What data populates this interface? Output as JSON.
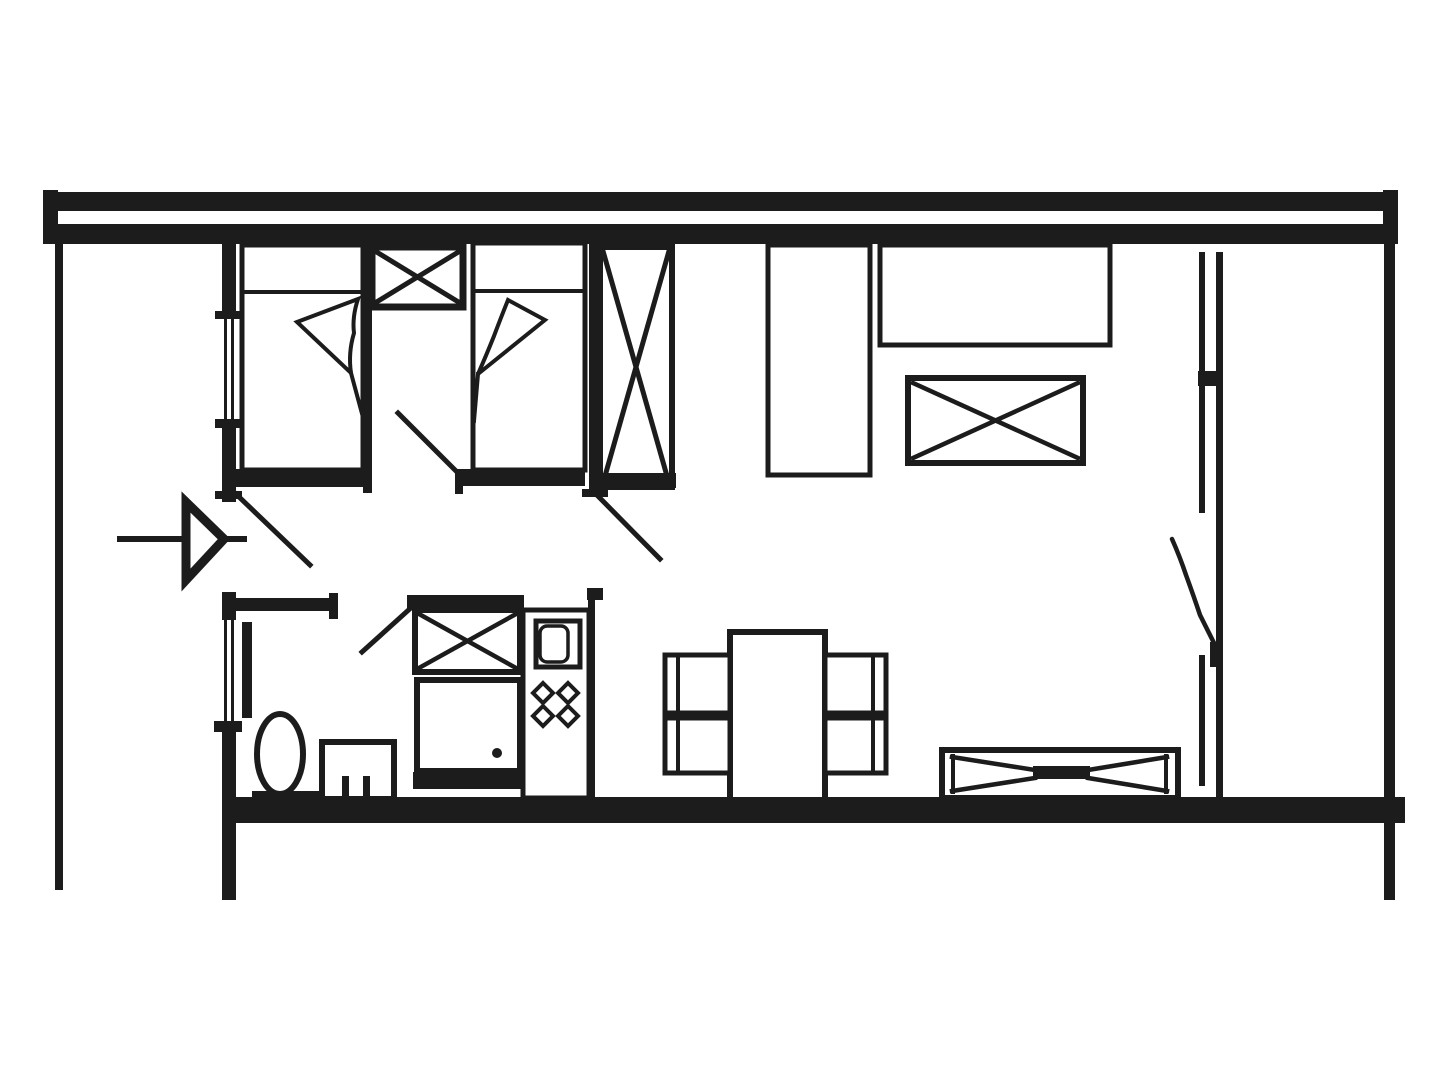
{
  "document": {
    "kind": "architectural-floor-plan",
    "canvas": {
      "width": 1440,
      "height": 1080,
      "background": "#ffffff",
      "ink": "#1c1c1c"
    }
  },
  "shapes": [
    {
      "n": "top-wall-upper-bar",
      "t": "r",
      "x": 43,
      "y": 192,
      "w": 1355,
      "h": 19,
      "f": true
    },
    {
      "n": "top-wall-lower-bar",
      "t": "r",
      "x": 55,
      "y": 224,
      "w": 1342,
      "h": 20,
      "f": true
    },
    {
      "n": "top-wall-left-cap",
      "t": "r",
      "x": 43,
      "y": 190,
      "w": 15,
      "h": 54,
      "f": true
    },
    {
      "n": "top-wall-right-cap",
      "t": "r",
      "x": 1383,
      "y": 190,
      "w": 15,
      "h": 54,
      "f": true
    },
    {
      "n": "terrace-left-edge-wall",
      "t": "r",
      "x": 55,
      "y": 244,
      "w": 8,
      "h": 646,
      "f": true
    },
    {
      "n": "outer-wall-right",
      "t": "r",
      "x": 1384,
      "y": 244,
      "w": 11,
      "h": 656,
      "f": true
    },
    {
      "n": "bottom-wall",
      "t": "r",
      "x": 222,
      "y": 797,
      "w": 1183,
      "h": 26,
      "f": true
    },
    {
      "n": "left-wall-segment-a",
      "t": "r",
      "x": 222,
      "y": 244,
      "w": 14,
      "h": 69,
      "f": true
    },
    {
      "n": "left-wall-tick-1",
      "t": "r",
      "x": 215,
      "y": 311,
      "w": 27,
      "h": 8,
      "f": true
    },
    {
      "n": "bedroom-window-glass-a",
      "t": "r",
      "x": 224,
      "y": 319,
      "w": 3,
      "h": 103,
      "f": true
    },
    {
      "n": "bedroom-window-glass-b",
      "t": "r",
      "x": 231,
      "y": 319,
      "w": 3,
      "h": 103,
      "f": true
    },
    {
      "n": "left-wall-tick-2",
      "t": "r",
      "x": 215,
      "y": 419,
      "w": 27,
      "h": 9,
      "f": true
    },
    {
      "n": "left-wall-segment-b",
      "t": "r",
      "x": 222,
      "y": 428,
      "w": 14,
      "h": 74,
      "f": true
    },
    {
      "n": "left-wall-tick-3",
      "t": "r",
      "x": 215,
      "y": 491,
      "w": 27,
      "h": 8,
      "f": true
    },
    {
      "n": "left-wall-segment-c",
      "t": "r",
      "x": 222,
      "y": 592,
      "w": 14,
      "h": 28,
      "f": true
    },
    {
      "n": "bathroom-window-glass-a",
      "t": "r",
      "x": 224,
      "y": 620,
      "w": 3,
      "h": 103,
      "f": true
    },
    {
      "n": "bathroom-window-glass-b",
      "t": "r",
      "x": 231,
      "y": 620,
      "w": 3,
      "h": 103,
      "f": true
    },
    {
      "n": "left-wall-tick-4",
      "t": "r",
      "x": 214,
      "y": 721,
      "w": 28,
      "h": 11,
      "f": true
    },
    {
      "n": "left-wall-segment-d",
      "t": "r",
      "x": 222,
      "y": 732,
      "w": 14,
      "h": 168,
      "f": true
    },
    {
      "n": "bathroom-wall",
      "t": "r",
      "x": 232,
      "y": 598,
      "w": 102,
      "h": 13,
      "f": true
    },
    {
      "n": "bathroom-wall-end-tick",
      "t": "r",
      "x": 329,
      "y": 593,
      "w": 9,
      "h": 26,
      "f": true
    },
    {
      "n": "bed-divider-wall",
      "t": "r",
      "x": 363,
      "y": 244,
      "w": 9,
      "h": 249,
      "f": true
    },
    {
      "n": "bedroom2-right-wall",
      "t": "r",
      "x": 589,
      "y": 238,
      "w": 10,
      "h": 252,
      "f": true
    },
    {
      "n": "bedroom2-wall-tick",
      "t": "r",
      "x": 582,
      "y": 489,
      "w": 26,
      "h": 8,
      "f": true
    },
    {
      "n": "bed-1",
      "t": "r",
      "x": 242,
      "y": 245,
      "w": 121,
      "h": 225,
      "sw": 5
    },
    {
      "n": "bed-1-pillow-line",
      "t": "l",
      "x1": 242,
      "y1": 292,
      "x2": 363,
      "y2": 292,
      "sw": 4
    },
    {
      "n": "bed-1-blanket-fold",
      "t": "p",
      "d": "M297,322 L358,299 Q352,317 354,333 Q348,353 351,373 Z",
      "sw": 4,
      "fill": "#ffffff"
    },
    {
      "n": "bed-1-blanket-tail",
      "t": "l",
      "x1": 351,
      "y1": 373,
      "x2": 364,
      "y2": 421,
      "sw": 4
    },
    {
      "n": "bed-1-foot-bar",
      "t": "r",
      "x": 228,
      "y": 469,
      "w": 137,
      "h": 18,
      "f": true
    },
    {
      "n": "wardrobe-small-crossed-box",
      "t": "r",
      "x": 372,
      "y": 247,
      "w": 91,
      "h": 60,
      "sw": 7
    },
    {
      "n": "wardrobe-small-x-line-a",
      "t": "l",
      "x1": 375,
      "y1": 251,
      "x2": 460,
      "y2": 303,
      "sw": 5
    },
    {
      "n": "wardrobe-small-x-line-b",
      "t": "l",
      "x1": 460,
      "y1": 251,
      "x2": 375,
      "y2": 303,
      "sw": 5
    },
    {
      "n": "bed-2",
      "t": "r",
      "x": 473,
      "y": 243,
      "w": 112,
      "h": 227,
      "sw": 5
    },
    {
      "n": "bed-2-pillow-line",
      "t": "l",
      "x1": 473,
      "y1": 291,
      "x2": 585,
      "y2": 291,
      "sw": 4
    },
    {
      "n": "bed-2-blanket-fold",
      "t": "p",
      "d": "M545,320 L508,300 Q500,320 494,336 Q486,356 478,374 Z",
      "sw": 4,
      "fill": "#ffffff"
    },
    {
      "n": "bed-2-blanket-tail",
      "t": "l",
      "x1": 478,
      "y1": 374,
      "x2": 474,
      "y2": 421,
      "sw": 4
    },
    {
      "n": "bed-2-foot-bar",
      "t": "r",
      "x": 456,
      "y": 469,
      "w": 129,
      "h": 17,
      "f": true
    },
    {
      "n": "bed-2-foot-tick",
      "t": "r",
      "x": 455,
      "y": 469,
      "w": 8,
      "h": 25,
      "f": true
    },
    {
      "n": "wardrobe-tall-crossed-box",
      "t": "r",
      "x": 600,
      "y": 247,
      "w": 72,
      "h": 240,
      "sw": 6
    },
    {
      "n": "wardrobe-tall-x-line-a",
      "t": "l",
      "x1": 603,
      "y1": 251,
      "x2": 669,
      "y2": 483,
      "sw": 5
    },
    {
      "n": "wardrobe-tall-x-line-b",
      "t": "l",
      "x1": 669,
      "y1": 251,
      "x2": 603,
      "y2": 483,
      "sw": 5
    },
    {
      "n": "wardrobe-tall-base-bar",
      "t": "r",
      "x": 593,
      "y": 473,
      "w": 83,
      "h": 15,
      "f": true
    },
    {
      "n": "bedroom1-door-leaf",
      "t": "l",
      "x1": 398,
      "y1": 413,
      "x2": 461,
      "y2": 476,
      "sw": 5
    },
    {
      "n": "bedroom2-door-leaf",
      "t": "l",
      "x1": 593,
      "y1": 491,
      "x2": 660,
      "y2": 559,
      "sw": 5
    },
    {
      "n": "entry-door-leaf",
      "t": "l",
      "x1": 236,
      "y1": 494,
      "x2": 310,
      "y2": 565,
      "sw": 5
    },
    {
      "n": "entry-arrow-shaft",
      "t": "l",
      "x1": 120,
      "y1": 539,
      "x2": 244,
      "y2": 539,
      "sw": 6
    },
    {
      "n": "entry-arrow-head",
      "t": "g",
      "pts": "224,539 186,502 186,580",
      "sw": 9,
      "fill": "#ffffff"
    },
    {
      "n": "bathroom-door-leaf-bar",
      "t": "r",
      "x": 242,
      "y": 622,
      "w": 10,
      "h": 96,
      "f": true
    },
    {
      "n": "toilet-bowl",
      "t": "e",
      "cx": 280,
      "cy": 754,
      "rx": 23,
      "ry": 40,
      "sw": 6
    },
    {
      "n": "toilet-base",
      "t": "r",
      "x": 252,
      "y": 791,
      "w": 69,
      "h": 9,
      "f": true
    },
    {
      "n": "bath-fixture-box",
      "t": "r",
      "x": 322,
      "y": 742,
      "w": 72,
      "h": 57,
      "sw": 6
    },
    {
      "n": "bath-fixture-tick-a",
      "t": "r",
      "x": 342,
      "y": 776,
      "w": 7,
      "h": 23,
      "f": true
    },
    {
      "n": "bath-fixture-tick-b",
      "t": "r",
      "x": 363,
      "y": 776,
      "w": 7,
      "h": 23,
      "f": true
    },
    {
      "n": "kitchen-header-bar",
      "t": "r",
      "x": 407,
      "y": 595,
      "w": 117,
      "h": 15,
      "f": true
    },
    {
      "n": "kitchen-closet-crossed-box",
      "t": "r",
      "x": 415,
      "y": 610,
      "w": 105,
      "h": 62,
      "sw": 6
    },
    {
      "n": "kitchen-closet-x-line-a",
      "t": "l",
      "x1": 419,
      "y1": 614,
      "x2": 516,
      "y2": 668,
      "sw": 4.5
    },
    {
      "n": "kitchen-closet-x-line-b",
      "t": "l",
      "x1": 516,
      "y1": 614,
      "x2": 419,
      "y2": 668,
      "sw": 4.5
    },
    {
      "n": "kitchen-closet-door-leaf",
      "t": "l",
      "x1": 362,
      "y1": 652,
      "x2": 413,
      "y2": 606,
      "sw": 5
    },
    {
      "n": "oven",
      "t": "r",
      "x": 417,
      "y": 680,
      "w": 103,
      "h": 91,
      "sw": 6
    },
    {
      "n": "oven-handle-dot",
      "t": "c",
      "cx": 497,
      "cy": 753,
      "r": 5
    },
    {
      "n": "kitchen-base-bar",
      "t": "r",
      "x": 413,
      "y": 772,
      "w": 109,
      "h": 17,
      "f": true
    },
    {
      "n": "kitchen-unit-outline",
      "t": "r",
      "x": 523,
      "y": 610,
      "w": 66,
      "h": 188,
      "sw": 5
    },
    {
      "n": "kitchen-right-hook",
      "t": "r",
      "x": 587,
      "y": 588,
      "w": 16,
      "h": 12,
      "f": true
    },
    {
      "n": "kitchen-right-wall-line",
      "t": "r",
      "x": 588,
      "y": 598,
      "w": 7,
      "h": 200,
      "f": true
    },
    {
      "n": "sink-box",
      "t": "r",
      "x": 536,
      "y": 621,
      "w": 44,
      "h": 46,
      "sw": 5
    },
    {
      "n": "sink-bowl",
      "t": "r",
      "x": 540,
      "y": 626,
      "w": 28,
      "h": 36,
      "rx": 7,
      "sw": 3.5
    },
    {
      "n": "burner-top-left",
      "t": "g",
      "pts": "543,683 553,693 543,703 533,693",
      "sw": 4,
      "fill": "#ffffff"
    },
    {
      "n": "burner-top-right",
      "t": "g",
      "pts": "568,683 578,693 568,703 558,693",
      "sw": 4,
      "fill": "#ffffff"
    },
    {
      "n": "burner-bottom-left",
      "t": "g",
      "pts": "543,706 553,716 543,726 533,716",
      "sw": 4,
      "fill": "#ffffff"
    },
    {
      "n": "burner-bottom-right",
      "t": "g",
      "pts": "568,706 578,716 568,726 558,716",
      "sw": 4,
      "fill": "#ffffff"
    },
    {
      "n": "dining-table",
      "t": "r",
      "x": 730,
      "y": 632,
      "w": 95,
      "h": 168,
      "sw": 6
    },
    {
      "n": "chair-top-left",
      "t": "r",
      "x": 665,
      "y": 655,
      "w": 65,
      "h": 58,
      "sw": 5
    },
    {
      "n": "chair-top-left-backrest",
      "t": "l",
      "x1": 678,
      "y1": 659,
      "x2": 678,
      "y2": 709,
      "sw": 4
    },
    {
      "n": "chair-bottom-left",
      "t": "r",
      "x": 665,
      "y": 718,
      "w": 65,
      "h": 55,
      "sw": 5
    },
    {
      "n": "chair-bottom-left-backrest",
      "t": "l",
      "x1": 678,
      "y1": 722,
      "x2": 678,
      "y2": 769,
      "sw": 4
    },
    {
      "n": "chair-top-right",
      "t": "r",
      "x": 825,
      "y": 655,
      "w": 61,
      "h": 58,
      "sw": 5
    },
    {
      "n": "chair-top-right-backrest",
      "t": "l",
      "x1": 873,
      "y1": 659,
      "x2": 873,
      "y2": 709,
      "sw": 4
    },
    {
      "n": "chair-bottom-right",
      "t": "r",
      "x": 825,
      "y": 718,
      "w": 61,
      "h": 55,
      "sw": 5
    },
    {
      "n": "chair-bottom-right-backrest",
      "t": "l",
      "x1": 873,
      "y1": 722,
      "x2": 873,
      "y2": 769,
      "sw": 4
    },
    {
      "n": "tall-cabinet",
      "t": "r",
      "x": 768,
      "y": 245,
      "w": 102,
      "h": 230,
      "sw": 5
    },
    {
      "n": "kitchen-counter",
      "t": "r",
      "x": 880,
      "y": 245,
      "w": 230,
      "h": 100,
      "sw": 5
    },
    {
      "n": "island-crossed-box",
      "t": "r",
      "x": 908,
      "y": 378,
      "w": 175,
      "h": 85,
      "sw": 6
    },
    {
      "n": "island-x-line-a",
      "t": "l",
      "x1": 913,
      "y1": 383,
      "x2": 1078,
      "y2": 458,
      "sw": 4.5
    },
    {
      "n": "island-x-line-b",
      "t": "l",
      "x1": 1078,
      "y1": 383,
      "x2": 913,
      "y2": 458,
      "sw": 4.5
    },
    {
      "n": "sofa-outline",
      "t": "r",
      "x": 942,
      "y": 750,
      "w": 236,
      "h": 48,
      "sw": 6
    },
    {
      "n": "sofa-armrest-left",
      "t": "l",
      "x1": 953,
      "y1": 756,
      "x2": 953,
      "y2": 792,
      "sw": 4
    },
    {
      "n": "sofa-armrest-right",
      "t": "l",
      "x1": 1166,
      "y1": 756,
      "x2": 1166,
      "y2": 792,
      "sw": 4
    },
    {
      "n": "sofa-fold-line-a",
      "t": "l",
      "x1": 952,
      "y1": 757,
      "x2": 1035,
      "y2": 770,
      "sw": 4.5
    },
    {
      "n": "sofa-fold-line-b",
      "t": "l",
      "x1": 952,
      "y1": 791,
      "x2": 1035,
      "y2": 778,
      "sw": 4.5
    },
    {
      "n": "sofa-fold-line-c",
      "t": "l",
      "x1": 1167,
      "y1": 757,
      "x2": 1088,
      "y2": 770,
      "sw": 4.5
    },
    {
      "n": "sofa-fold-line-d",
      "t": "l",
      "x1": 1167,
      "y1": 791,
      "x2": 1088,
      "y2": 778,
      "sw": 4.5
    },
    {
      "n": "sofa-center-bar",
      "t": "r",
      "x": 1033,
      "y": 766,
      "w": 57,
      "h": 13,
      "f": true
    },
    {
      "n": "balcony-window-outer-upper",
      "t": "r",
      "x": 1199,
      "y": 252,
      "w": 6,
      "h": 261,
      "f": true
    },
    {
      "n": "balcony-window-outer-lower",
      "t": "r",
      "x": 1199,
      "y": 655,
      "w": 6,
      "h": 131,
      "f": true
    },
    {
      "n": "balcony-window-inner-rail",
      "t": "r",
      "x": 1216,
      "y": 252,
      "w": 7,
      "h": 546,
      "f": true
    },
    {
      "n": "balcony-window-connector",
      "t": "r",
      "x": 1198,
      "y": 371,
      "w": 25,
      "h": 15,
      "f": true
    },
    {
      "n": "balcony-door-hinge-block",
      "t": "r",
      "x": 1210,
      "y": 642,
      "w": 13,
      "h": 25,
      "f": true
    },
    {
      "n": "balcony-door-leaf",
      "t": "p",
      "d": "M1172,539 q8,18 14,36 q8,22 14,40 q9,18 17,34",
      "sw": 4.5,
      "fill": "none"
    }
  ]
}
